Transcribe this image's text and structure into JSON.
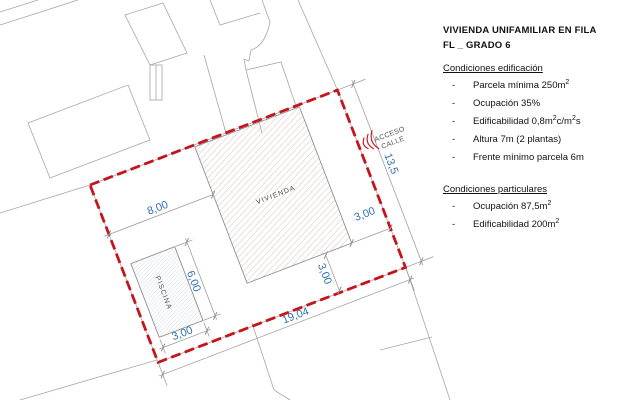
{
  "panel": {
    "title_line1": "VIVIENDA UNIFAMILIAR EN FILA",
    "title_line2": "FL _ GRADO 6",
    "bullet": "-",
    "sections": [
      {
        "heading": "Condiciones edificación",
        "items": [
          {
            "parts": [
              {
                "text": "Parcela mínima 250m"
              },
              {
                "text": "2"
              }
            ]
          },
          {
            "parts": [
              {
                "text": "Ocupación 35%"
              }
            ]
          },
          {
            "parts": [
              {
                "text": "Edificabilidad 0,8m"
              },
              {
                "text": "2"
              },
              {
                "text": "c/m"
              },
              {
                "text": "2"
              },
              {
                "text": "s"
              }
            ]
          },
          {
            "parts": [
              {
                "text": "Altura 7m (2 plantas)"
              }
            ]
          },
          {
            "parts": [
              {
                "text": "Frente mínimo parcela 6m"
              }
            ]
          }
        ]
      },
      {
        "heading": "Condiciones particulares",
        "items": [
          {
            "parts": [
              {
                "text": "Ocupación 87,5m"
              },
              {
                "text": "2"
              }
            ]
          },
          {
            "parts": [
              {
                "text": "Edificabilidad 200m"
              },
              {
                "text": "2"
              }
            ]
          }
        ]
      }
    ]
  },
  "drawing": {
    "labels": {
      "building": "VIVIENDA",
      "pool": "PISCINA",
      "access_line1": "ACCESO",
      "access_line2": "CALLE"
    },
    "dimensions": {
      "left_setback": "8,00",
      "right_setback": "3,00",
      "bottom_setback": "3,00",
      "parcel_width": "19,04",
      "parcel_depth": "13,5",
      "pool_length": "6,00",
      "pool_width": "3,00"
    },
    "colors": {
      "parcel_boundary": "#c4151c",
      "dimension_text": "#3271b3",
      "building_hatch": "#c7a9a4",
      "pool_hatch": "#b7c3d6",
      "neighbor_lines": "#a6a6a6",
      "label_text": "#4f4f4f"
    }
  }
}
